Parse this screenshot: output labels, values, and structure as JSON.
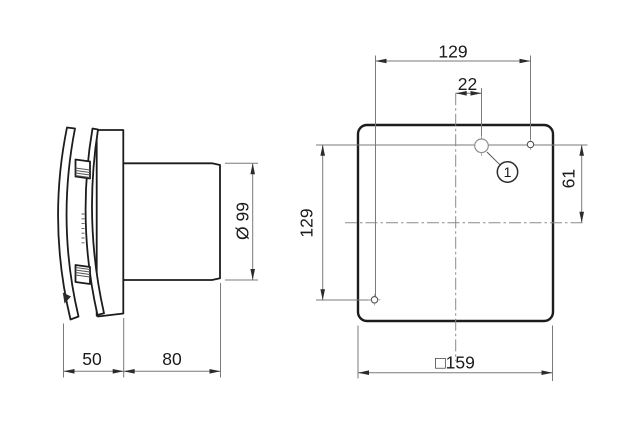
{
  "side_view": {
    "depth_cover": "50",
    "depth_duct": "80",
    "duct_diameter": "Ø 99"
  },
  "front_view": {
    "hole_span_horizontal": "129",
    "hole_center_offset": "22",
    "hole_span_vertical": "129",
    "hole_to_centerline": "61",
    "panel_size": "□159",
    "callout_label": "1"
  },
  "colors": {
    "object_line": "#1c1c1c",
    "dimension_line": "#7a7a7a",
    "centerline": "#8a8a8a",
    "text": "#1a1a1a",
    "background": "#ffffff"
  }
}
